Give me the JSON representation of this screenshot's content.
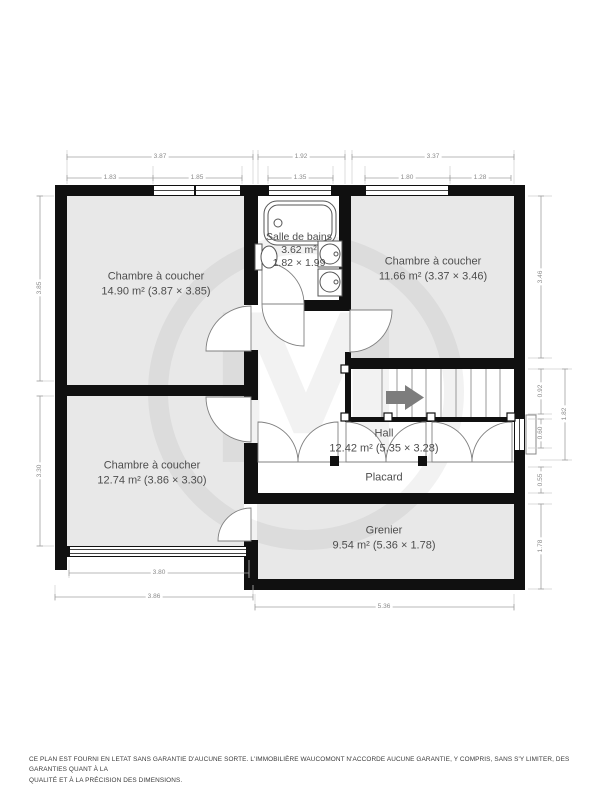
{
  "watermark_letter": "M",
  "rooms": {
    "bed1": {
      "name": "Chambre à coucher",
      "line2": "14.90 m² (3.87 × 3.85)"
    },
    "bath": {
      "name": "Salle de bains",
      "area": "3.62 m²",
      "size": "1.82 × 1.99"
    },
    "bed2": {
      "name": "Chambre à coucher",
      "line2": "11.66 m² (3.37 × 3.46)"
    },
    "bed3": {
      "name": "Chambre à coucher",
      "line2": "12.74 m² (3.86 × 3.30)"
    },
    "hall": {
      "name": "Hall",
      "line2": "12.42 m² (5.35 × 3.28)"
    },
    "placard": {
      "name": "Placard"
    },
    "grenier": {
      "name": "Grenier",
      "line2": "9.54 m² (5.36 × 1.78)"
    }
  },
  "dimensions": {
    "top": {
      "d387": "3.87",
      "d192": "1.92",
      "d337": "3.37",
      "d183": "1.83",
      "d185": "1.85",
      "d135": "1.35",
      "d180": "1.80",
      "d128": "1.28"
    },
    "left": {
      "d385": "3.85",
      "d330": "3.30"
    },
    "right": {
      "d346": "3.46",
      "d092": "0.92",
      "d060": "0.60",
      "d182": "1.82",
      "d055": "0.55",
      "d178": "1.78"
    },
    "bottom": {
      "d380": "3.80",
      "d386": "3.86",
      "d536": "5.36"
    }
  },
  "footer": {
    "line1": "CE PLAN EST FOURNI EN LETAT SANS GARANTIE D'AUCUNE SORTE. L'IMMOBILIÈRE WAUCOMONT N'ACCORDE AUCUNE GARANTIE, Y COMPRIS, SANS S'Y LIMITER, DES GARANTIES QUANT À LA",
    "line2": "QUALITÉ ET À LA PRÉCISION DES DIMENSIONS."
  },
  "colors": {
    "wall": "#101010",
    "floor": "#e8e8e8",
    "accent_arrow": "#7d7d7d"
  }
}
